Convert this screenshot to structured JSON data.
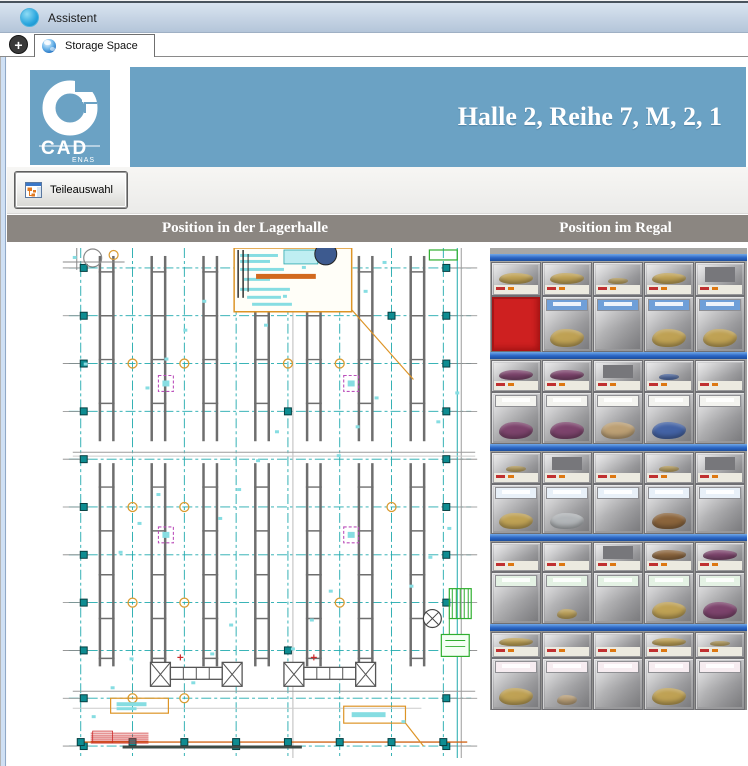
{
  "window": {
    "title": "Assistent"
  },
  "tabs": {
    "new_tab": "+",
    "items": [
      {
        "label": "Storage Space"
      }
    ]
  },
  "logo": {
    "cad": "CAD",
    "enas": "ENAS"
  },
  "banner": {
    "title": "Halle 2, Reihe 7, M, 2, 1",
    "bg_color": "#6ba2c4"
  },
  "toolbar": {
    "parts_button_label": "Teileauswahl"
  },
  "sections": {
    "left_header": "Position in der Lagerhalle",
    "right_header": "Position im Regal",
    "bar_color": "#8b8681"
  },
  "floorplan": {
    "palette": {
      "grid_teal": "#1fa9ad",
      "rack_gray": "#6e6e6e",
      "accent_orange": "#dd9426",
      "marker_magenta": "#bb4fbb",
      "green": "#2fae2f",
      "red": "#cc2a2a"
    }
  },
  "shelf_photo": {
    "grid": {
      "rows": 10,
      "cols": 5
    },
    "highlight": {
      "row": 2,
      "col": 1,
      "color": "#ce2020"
    },
    "rail_color": "#2a65c4",
    "contents": [
      [
        "gold",
        "gold",
        "gold_s",
        "gold",
        "redact"
      ],
      [
        "red",
        "gold",
        "none",
        "gold",
        "gold"
      ],
      [
        "purple",
        "purple",
        "redact",
        "blue_s",
        "none"
      ],
      [
        "purple",
        "purple",
        "tan",
        "blue",
        "none"
      ],
      [
        "gold_s",
        "redact",
        "none",
        "gold_s",
        "redact"
      ],
      [
        "gold",
        "silver",
        "none",
        "brown",
        "none"
      ],
      [
        "none",
        "none",
        "redact",
        "brown",
        "purple"
      ],
      [
        "none",
        "gold_s",
        "none",
        "gold",
        "purple"
      ],
      [
        "gold",
        "none",
        "none",
        "gold",
        "gold_s"
      ],
      [
        "gold",
        "tan_s",
        "none",
        "gold",
        "none"
      ]
    ]
  }
}
